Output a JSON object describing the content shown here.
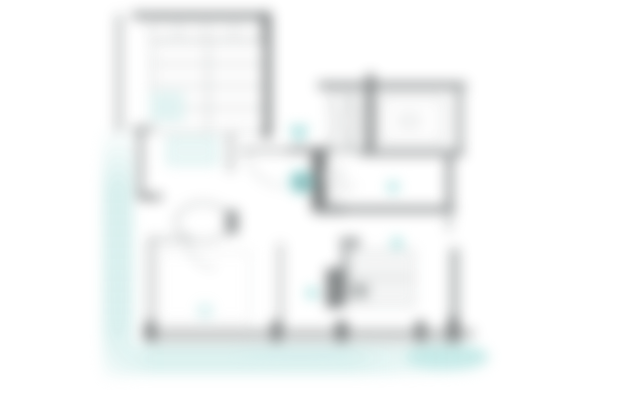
{
  "floor_plan": {
    "markers": [
      {
        "id": "hall-marker",
        "label": "1",
        "shape": "filled-circle"
      },
      {
        "id": "room-marker",
        "label": "2",
        "shape": "outline-circle"
      }
    ],
    "icons": [
      {
        "name": "entrance-arrow-icon",
        "meaning": "entry direction triangle"
      },
      {
        "name": "room-dot",
        "meaning": "small teal room indicator"
      }
    ],
    "colors": {
      "accent_teal": "#96d9d8",
      "teal_soft": "#ddf2f1",
      "teal_dot": "#aee4e2",
      "terrace_teal": "#d7f0ee",
      "wall_gray": "#8f9394",
      "wall_dark": "#6e7273",
      "wall_light": "#a7abab",
      "line_light": "#b9bdbd",
      "line_arc": "#b3b7b7",
      "marker_num_dark": "#5f6466",
      "marker_num_light": "#b9bdbd"
    }
  }
}
